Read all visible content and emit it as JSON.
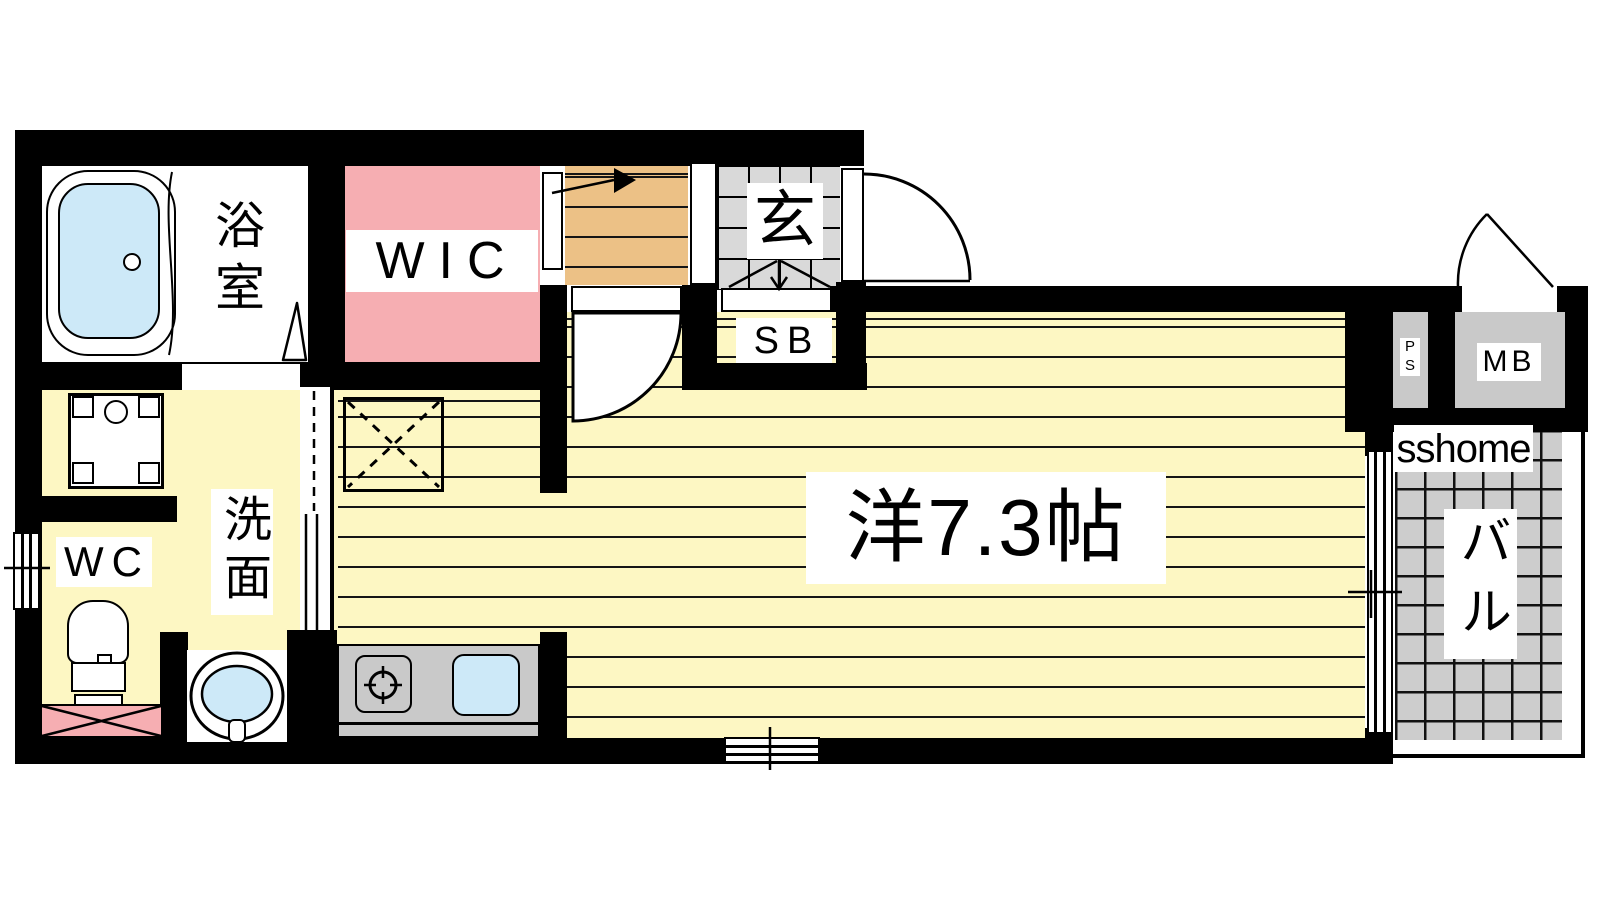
{
  "rooms": {
    "bathroom": {
      "label": "浴室"
    },
    "wic": {
      "label": "WIC"
    },
    "entrance": {
      "label": "玄"
    },
    "shoe_box": {
      "label": "SB"
    },
    "toilet": {
      "label": "WC"
    },
    "washroom": {
      "label": "洗面"
    },
    "main_room": {
      "label": "洋7.3帖",
      "size_jo": 7.3
    },
    "balcony": {
      "label": "バル"
    },
    "pipe_space": {
      "label": "PS"
    },
    "meter_box": {
      "label": "MB"
    }
  },
  "watermark": {
    "text": "sshome"
  },
  "colors": {
    "wall": "#000000",
    "closet_pink": "#f6aeb2",
    "floor_yellow": "#fdf7c3",
    "wood_tan": "#ecc186",
    "water_blue": "#cde9f8",
    "entry_tile_gray": "#d9d9d9",
    "balcony_tile_gray": "#cdcdcd",
    "fixture_gray": "#c9c9c9"
  }
}
